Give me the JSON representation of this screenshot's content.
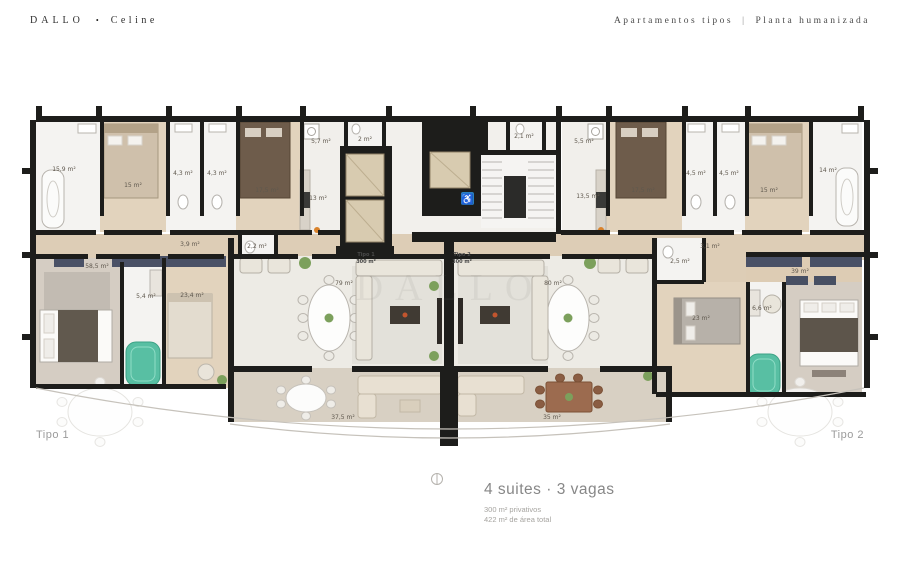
{
  "header": {
    "brand": "DALLO",
    "bullet": "•",
    "project": "Celine",
    "subtitle_left": "Apartamentos tipos",
    "subtitle_divider": "|",
    "subtitle_right": "Planta humanizada"
  },
  "plan": {
    "watermark": "DALLO",
    "unit1_corner_label": "Tipo 1",
    "unit2_corner_label": "Tipo 2",
    "core": {
      "unit1_name": "Tipo 1",
      "unit1_area": "300 m²",
      "unit2_name": "Tipo 2",
      "unit2_area": "300 m²"
    },
    "accessibility_icon": "♿",
    "area_labels": [
      "15,9 m²",
      "15 m²",
      "4,3 m²",
      "4,3 m²",
      "17,5 m²",
      "5,7 m²",
      "2 m²",
      "13 m²",
      "3,9 m²",
      "2,2 m²",
      "58,5 m²",
      "5,4 m²",
      "23,4 m²",
      "79 m²",
      "37,5 m²",
      "2,1 m²",
      "5,5 m²",
      "13,5 m²",
      "17,5 m²",
      "4,5 m²",
      "4,5 m²",
      "15 m²",
      "14 m²",
      "3,1 m²",
      "2,5 m²",
      "23 m²",
      "6,6 m²",
      "39 m²",
      "80 m²",
      "35 m²"
    ]
  },
  "footer": {
    "title": "4 suites · 3 vagas",
    "privative": "300 m² privativos",
    "total": "422 m² de área total"
  },
  "colors": {
    "wall": "#1d1d1b",
    "wood_floor": "#ddcdb6",
    "bedroom_floor": "#e2d3bd",
    "living_floor": "#edebe5",
    "terrace_floor": "#d8d0c3",
    "bath_floor": "#f4f3f1",
    "carpet": "#d5cdc3",
    "wardrobe_navy": "#4a5166",
    "jacuzzi_teal": "#58bfa3",
    "marble_beige": "#d8cbb0",
    "accessibility_blue": "#2a7fc1",
    "plant_green": "#7ca05c",
    "accent_orange": "#d9822b",
    "table_wood": "#9c6b4f"
  }
}
